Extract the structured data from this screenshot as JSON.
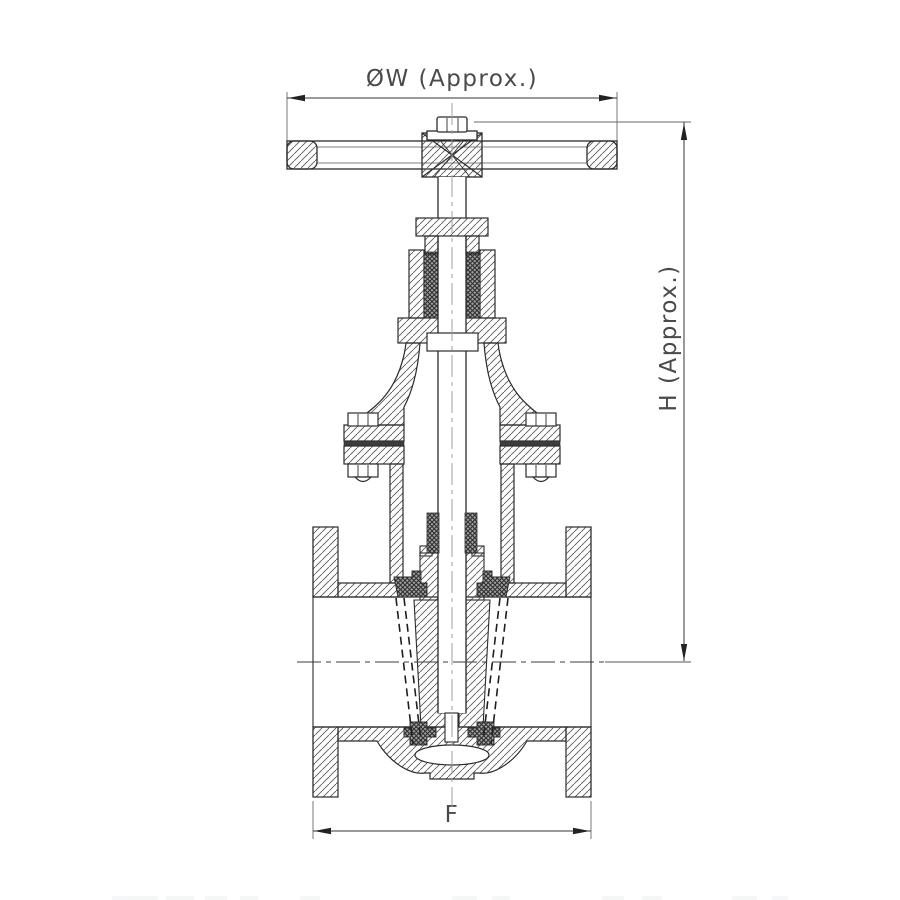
{
  "drawing": {
    "title": "gate-valve-sectional-drawing",
    "dimensions": {
      "width_label": "ØW (Approx.)",
      "height_label": "H (Approx.)",
      "face_to_face_label": "F"
    },
    "colors": {
      "background": "#ffffff",
      "outline": "#2b2b2b",
      "hatch": "#5a5a5a",
      "packing_dark": "#2e2e2e",
      "gasket": "#3d3d3d",
      "centerline": "#9aa0a3",
      "dimension": "#4a4a4a"
    }
  }
}
